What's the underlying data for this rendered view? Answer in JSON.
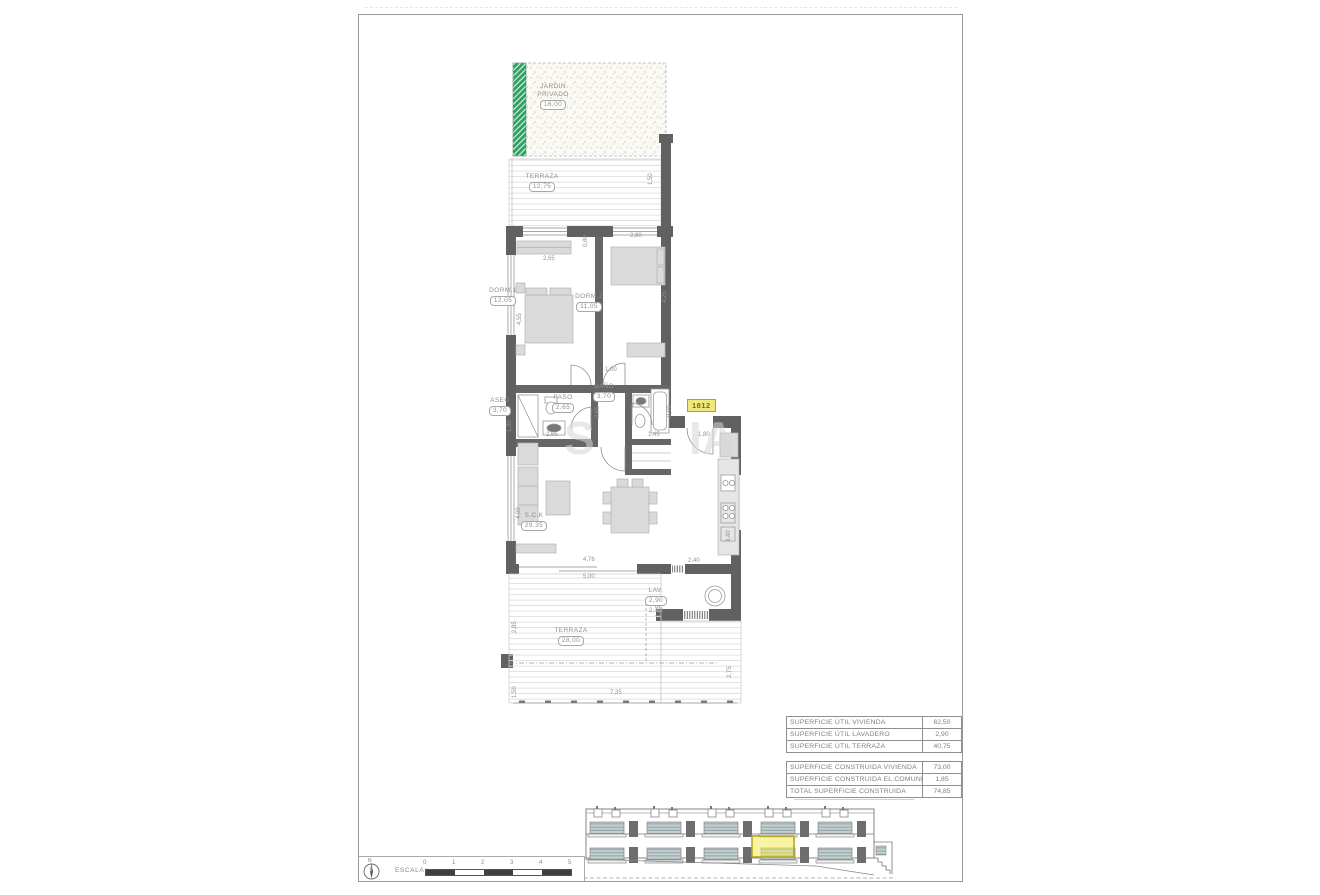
{
  "colors": {
    "wall": "#616161",
    "green": "#2fa065",
    "yellow_highlight": "#efe97b",
    "line_gray": "#8f8f8f"
  },
  "plan": {
    "garden": {
      "name": "JARDIN",
      "name2": "PRIVADO",
      "value": "16,00"
    },
    "rooms": [
      {
        "id": "jardin-privado",
        "name": "JARDIN",
        "name2": "PRIVADO",
        "value": "16,00",
        "x": 239,
        "y": 68
      },
      {
        "id": "terraza-top",
        "name": "TERRAZA",
        "value": "12,75",
        "x": 228,
        "y": 158
      },
      {
        "id": "dorm-1",
        "name": "DORM.1",
        "value": "12,05",
        "x": 189,
        "y": 272
      },
      {
        "id": "dorm-2",
        "name": "DORM.2",
        "value": "11,05",
        "x": 275,
        "y": 278
      },
      {
        "id": "aseo",
        "name": "ASEO",
        "value": "3,70",
        "x": 186,
        "y": 382
      },
      {
        "id": "paso",
        "name": "PASO",
        "value": "2,65",
        "x": 249,
        "y": 379
      },
      {
        "id": "bano",
        "name": "BAÑO",
        "value": "3,70",
        "x": 290,
        "y": 368
      },
      {
        "id": "salon-cocina",
        "name": "S.C.K",
        "value": "29,35",
        "x": 220,
        "y": 497
      },
      {
        "id": "lavadero",
        "name": "LAV.",
        "value": "2,90",
        "sub": "2,10",
        "x": 342,
        "y": 572
      },
      {
        "id": "terraza-bottom",
        "name": "TERRAZA",
        "value": "28,00",
        "x": 257,
        "y": 612
      }
    ],
    "dimensions": [
      {
        "t": "0,80",
        "x": 224,
        "y": 222,
        "v": true
      },
      {
        "t": "2,80",
        "x": 271,
        "y": 218
      },
      {
        "t": "2,65",
        "x": 184,
        "y": 241
      },
      {
        "t": "4,55",
        "x": 158,
        "y": 300,
        "v": true
      },
      {
        "t": "4,25",
        "x": 303,
        "y": 278,
        "v": true
      },
      {
        "t": "1,50",
        "x": 289,
        "y": 160,
        "v": true
      },
      {
        "t": "1,00",
        "x": 246,
        "y": 352
      },
      {
        "t": "2,65",
        "x": 187,
        "y": 417
      },
      {
        "t": "2,65",
        "x": 236,
        "y": 393,
        "v": true
      },
      {
        "t": "0,90",
        "x": 308,
        "y": 392,
        "v": true
      },
      {
        "t": "1,45",
        "x": 289,
        "y": 417
      },
      {
        "t": "1,80",
        "x": 339,
        "y": 417
      },
      {
        "t": "1,30",
        "x": 148,
        "y": 407,
        "v": true
      },
      {
        "t": "4,00",
        "x": 157,
        "y": 494,
        "v": true
      },
      {
        "t": "4,76",
        "x": 224,
        "y": 542
      },
      {
        "t": "5,00",
        "x": 224,
        "y": 559
      },
      {
        "t": "2,40",
        "x": 329,
        "y": 543
      },
      {
        "t": "3,40",
        "x": 367,
        "y": 517,
        "v": true
      },
      {
        "t": "1,35",
        "x": 297,
        "y": 592,
        "v": true
      },
      {
        "t": "2,85",
        "x": 153,
        "y": 608,
        "v": true
      },
      {
        "t": "1,50",
        "x": 153,
        "y": 673,
        "v": true
      },
      {
        "t": "2,75",
        "x": 368,
        "y": 653,
        "v": true
      },
      {
        "t": "7,35",
        "x": 251,
        "y": 675
      }
    ],
    "unit_badge": {
      "text": "1812"
    },
    "watermark": {
      "fragments": [
        {
          "t": "S",
          "x": 205,
          "y": 396
        },
        {
          "t": "IA",
          "x": 330,
          "y": 396
        }
      ]
    }
  },
  "area_tables": [
    {
      "rows": [
        {
          "label": "SUPERFICIE ÚTIL VIVIENDA",
          "value": "62,50"
        },
        {
          "label": "SUPERFICIE ÚTIL LAVADERO",
          "value": "2,90"
        },
        {
          "label": "SUPERFICIE ÚTIL TERRAZA",
          "value": "40,75"
        }
      ]
    },
    {
      "rows": [
        {
          "label": "SUPERFICIE CONSTRUIDA VIVIENDA",
          "value": "73,00"
        },
        {
          "label": "SUPERFICIE CONSTRUIDA EL.COMUNES",
          "value": "1,85"
        },
        {
          "label": "TOTAL SUPERFICIE CONSTRUIDA",
          "value": "74,85"
        }
      ]
    }
  ],
  "scale_bar": {
    "label": "ESCALA :",
    "north_label": "N",
    "ticks": [
      "0",
      "1",
      "2",
      "3",
      "4",
      "5"
    ]
  }
}
